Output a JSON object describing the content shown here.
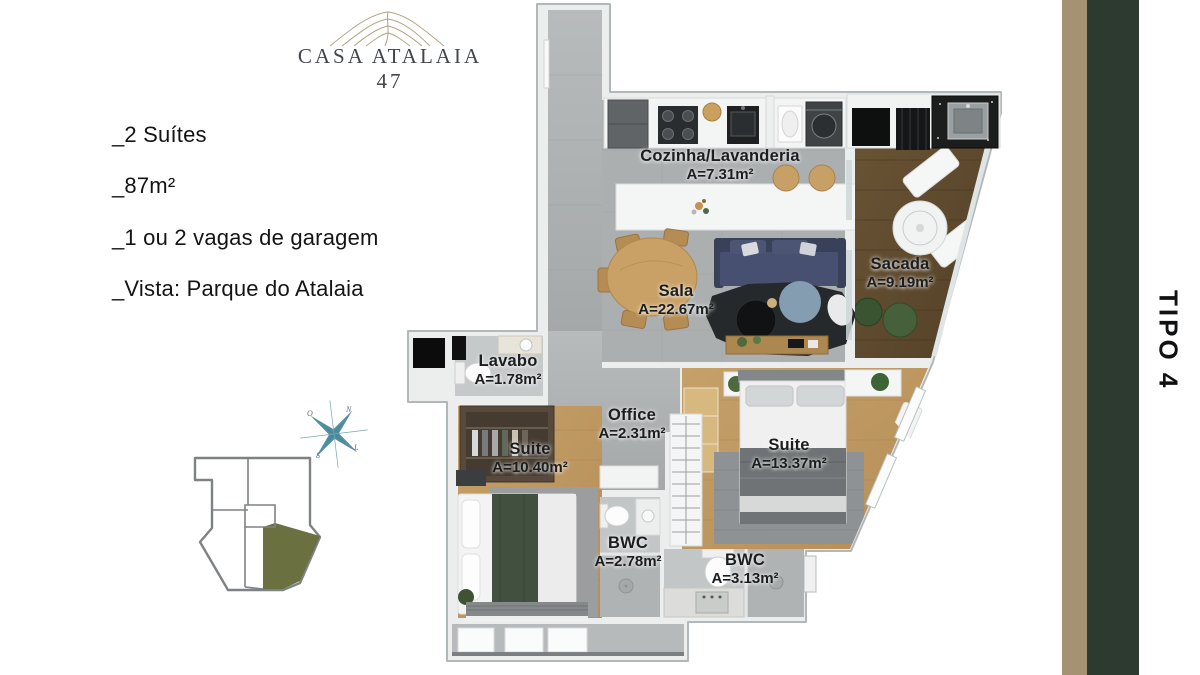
{
  "brand": {
    "name": "CASA ATALAIA 47"
  },
  "features": {
    "items": [
      "_2 Suítes",
      "_87m²",
      "_1 ou 2 vagas de garagem",
      "_Vista: Parque do Atalaia"
    ]
  },
  "unit": {
    "label": "TIPO 4"
  },
  "compass": {
    "n": "N",
    "e": "L",
    "s": "S",
    "w": "O"
  },
  "floor_plan": {
    "rooms": [
      {
        "name": "Cozinha/Lavanderia",
        "area": "A=7.31m²"
      },
      {
        "name": "Sala",
        "area": "A=22.67m²"
      },
      {
        "name": "Sacada",
        "area": "A=9.19m²"
      },
      {
        "name": "Lavabo",
        "area": "A=1.78m²"
      },
      {
        "name": "Office",
        "area": "A=2.31m²"
      },
      {
        "name": "Suite",
        "area": "A=10.40m²"
      },
      {
        "name": "Suite",
        "area": "A=13.37m²"
      },
      {
        "name": "BWC",
        "area": "A=2.78m²"
      },
      {
        "name": "BWC",
        "area": "A=3.13m²"
      }
    ]
  },
  "colors": {
    "accent_tan": "#a59272",
    "accent_green": "#2d3a30",
    "keyplan_highlight": "#6b7040",
    "compass_teal": "#3e8496"
  }
}
